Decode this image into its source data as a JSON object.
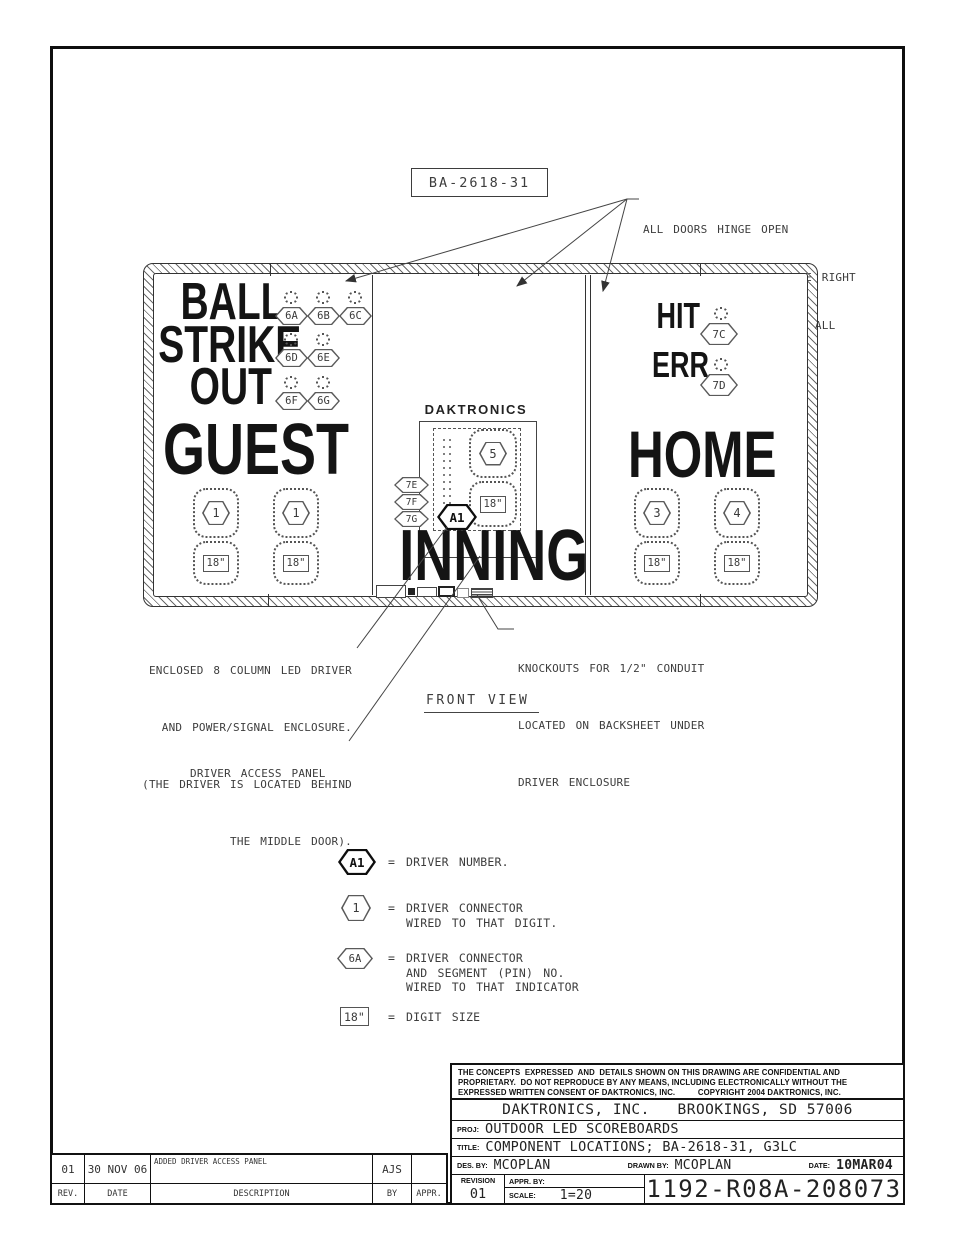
{
  "colors": {
    "line": "#3d3d3d",
    "text": "#141414",
    "background": "#ffffff"
  },
  "icons": {
    "indicator_lamp": "dot-cluster",
    "connector_tag": "hexagon-outline",
    "digit_outline": "dotted-stadium"
  },
  "drawing": {
    "number_label": "BA-2618-31",
    "view_label": "FRONT VIEW"
  },
  "notes": {
    "doors": [
      "ALL DOORS HINGE OPEN",
      "(THE MIDDLE DOOR OR THE RIGHT",
      "DOOR MUST BE SECURE AT ALL",
      "TIMES)."
    ],
    "enclosed": [
      "ENCLOSED 8 COLUMN LED DRIVER",
      "AND POWER/SIGNAL ENCLOSURE.",
      "(THE DRIVER IS LOCATED BEHIND",
      "THE MIDDLE DOOR)."
    ],
    "knockouts": [
      "KNOCKOUTS FOR 1/2\" CONDUIT",
      "LOCATED ON BACKSHEET UNDER",
      "DRIVER ENCLOSURE"
    ],
    "driver_access": "DRIVER ACCESS PANEL"
  },
  "board": {
    "brand": "DAKTRONICS",
    "left": {
      "ball": "BALL",
      "ball_tags": [
        "6A",
        "6B",
        "6C"
      ],
      "strike": "STRIKE",
      "strike_tags": [
        "6D",
        "6E"
      ],
      "out": "OUT",
      "out_tags": [
        "6F",
        "6G"
      ],
      "team": "GUEST",
      "digit1_connector": "1",
      "digit1_size": "18\"",
      "digit2_connector": "1",
      "digit2_size": "18\""
    },
    "middle": {
      "inning": "INNING",
      "connectors": [
        "7E",
        "7F",
        "7G"
      ],
      "driver": "A1",
      "digit_connector": "5",
      "digit_size": "18\""
    },
    "right": {
      "hit": "HIT",
      "hit_tag": "7C",
      "err": "ERR",
      "err_tag": "7D",
      "team": "HOME",
      "digit1_connector": "3",
      "digit1_size": "18\"",
      "digit2_connector": "4",
      "digit2_size": "18\""
    }
  },
  "legend": {
    "equals": "=",
    "driver_symbol": "A1",
    "driver_text": "DRIVER NUMBER.",
    "digit_symbol": "1",
    "digit_lines": [
      "DRIVER CONNECTOR",
      "WIRED TO THAT DIGIT."
    ],
    "indicator_symbol": "6A",
    "indicator_lines": [
      "DRIVER CONNECTOR",
      "AND SEGMENT (PIN) NO.",
      "WIRED TO THAT INDICATOR"
    ],
    "size_symbol": "18\"",
    "size_text": "DIGIT SIZE"
  },
  "title_block": {
    "disclaimer": [
      "THE CONCEPTS  EXPRESSED  AND  DETAILS SHOWN ON THIS DRAWING ARE CONFIDENTIAL AND",
      "PROPRIETARY.  DO NOT REPRODUCE BY ANY MEANS, INCLUDING ELECTRONICALLY WITHOUT THE",
      "EXPRESSED WRITTEN CONSENT OF DAKTRONICS, INC.          COPYRIGHT 2004 DAKTRONICS, INC."
    ],
    "company": "DAKTRONICS, INC.   BROOKINGS, SD 57006",
    "proj_label": "PROJ:",
    "proj": "OUTDOOR LED SCOREBOARDS",
    "title_label": "TITLE:",
    "title": "COMPONENT LOCATIONS; BA-2618-31, G3LC",
    "des_label": "DES. BY:",
    "des": "MCOPLAN",
    "drawn_label": "DRAWN BY:",
    "drawn": "MCOPLAN",
    "date_label": "DATE:",
    "date": "10MAR04",
    "revision_label": "REVISION",
    "revision": "01",
    "appr_label": "APPR. BY:",
    "scale_label": "SCALE:",
    "scale": "1=20",
    "number": "1192-R08A-208073"
  },
  "revision_table": {
    "row": {
      "rev": "01",
      "date": "30 NOV 06",
      "description": "ADDED DRIVER ACCESS PANEL",
      "by": "AJS",
      "appr": ""
    },
    "headers": {
      "rev": "REV.",
      "date": "DATE",
      "description": "DESCRIPTION",
      "by": "BY",
      "appr": "APPR."
    }
  }
}
